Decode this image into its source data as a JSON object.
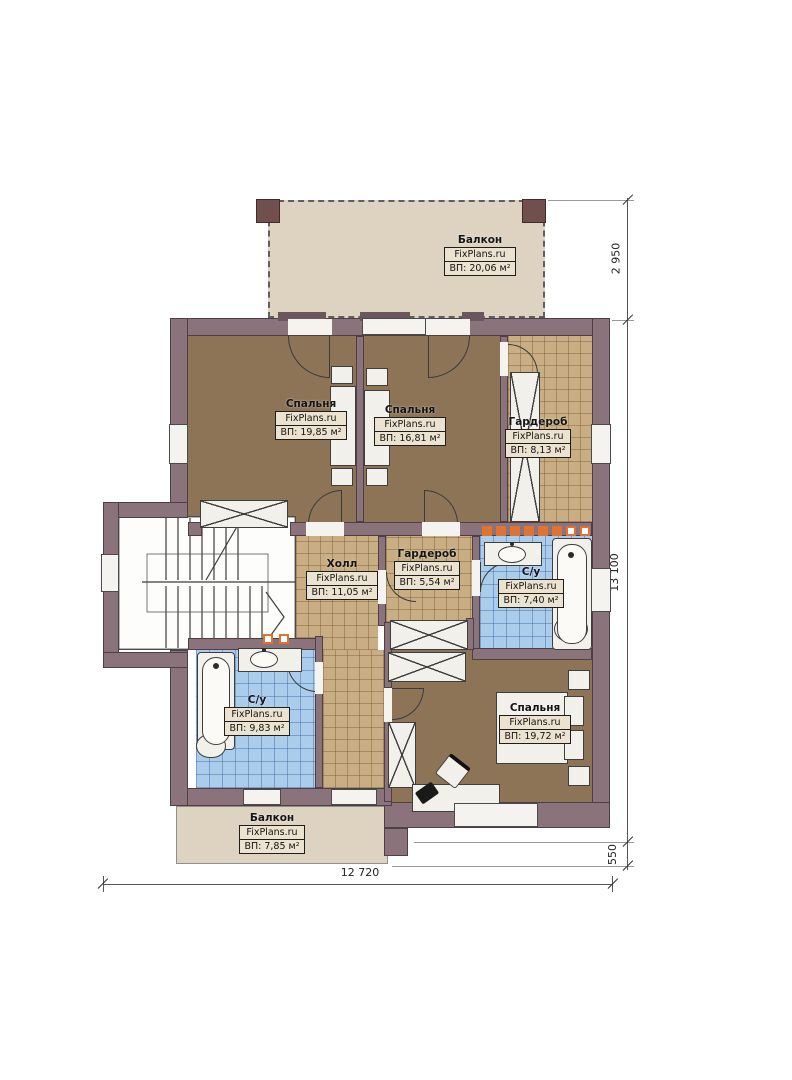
{
  "plan": {
    "brand": "FixPlans.ru",
    "rooms": [
      {
        "id": "balcony-top",
        "name": "Балкон",
        "brand": "FixPlans.ru",
        "area": "ВП: 20,06 м²"
      },
      {
        "id": "bedroom-1",
        "name": "Спальня",
        "brand": "FixPlans.ru",
        "area": "ВП: 19,85 м²"
      },
      {
        "id": "bedroom-2",
        "name": "Спальня",
        "brand": "FixPlans.ru",
        "area": "ВП: 16,81 м²"
      },
      {
        "id": "wardrobe-1",
        "name": "Гардероб",
        "brand": "FixPlans.ru",
        "area": "ВП: 8,13 м²"
      },
      {
        "id": "hall",
        "name": "Холл",
        "brand": "FixPlans.ru",
        "area": "ВП: 11,05 м²"
      },
      {
        "id": "wardrobe-2",
        "name": "Гардероб",
        "brand": "FixPlans.ru",
        "area": "ВП: 5,54 м²"
      },
      {
        "id": "bathroom-right",
        "name": "С/у",
        "brand": "FixPlans.ru",
        "area": "ВП: 7,40 м²"
      },
      {
        "id": "bathroom-left",
        "name": "С/у",
        "brand": "FixPlans.ru",
        "area": "ВП: 9,83 м²"
      },
      {
        "id": "bedroom-3",
        "name": "Спальня",
        "brand": "FixPlans.ru",
        "area": "ВП: 19,72 м²"
      },
      {
        "id": "balcony-bottom",
        "name": "Балкон",
        "brand": "FixPlans.ru",
        "area": "ВП: 7,85 м²"
      }
    ],
    "dims": {
      "right_top": "2 950",
      "right_middle": "13 100",
      "right_bottom": "550",
      "bottom": "12 720"
    },
    "colors": {
      "wall": "#8b737c",
      "bedroom_floor": "#8d7456",
      "tile_floor": "#c9ae83",
      "bath_tile": "#abcdec",
      "balcony": "#ded3c1",
      "label_bg": "#ebe2cf",
      "spotlight": "#dd7434"
    }
  }
}
